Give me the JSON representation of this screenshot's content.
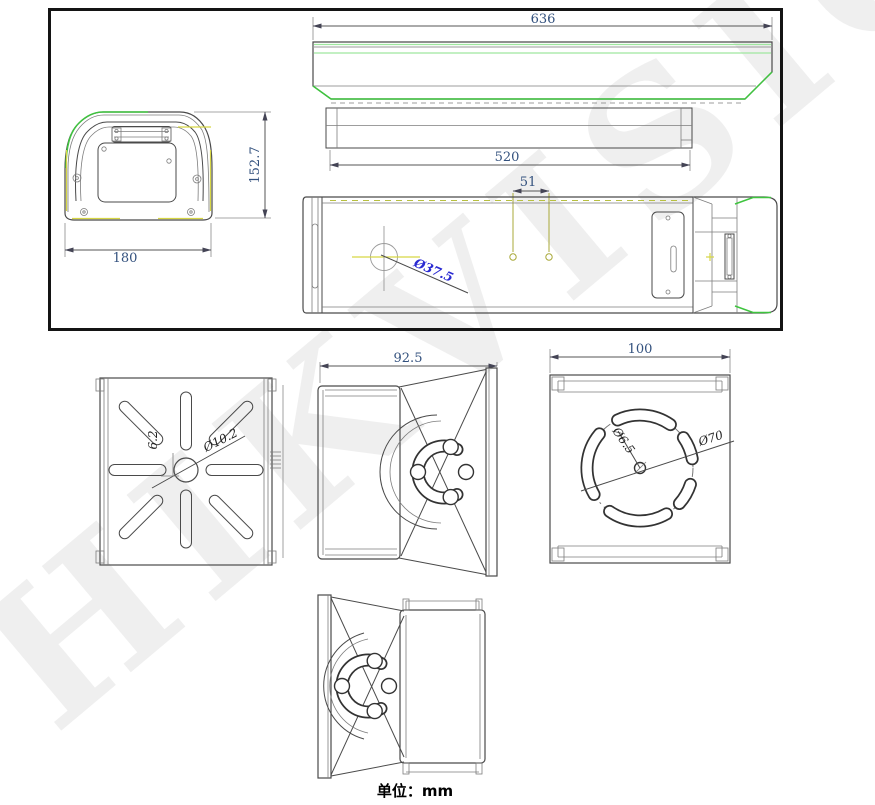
{
  "watermark": {
    "text": "HIKVISION"
  },
  "front_view": {
    "width_dim": "180",
    "height_dim": "152.7"
  },
  "top_view": {
    "overall_width_dim": "636",
    "body_width_dim": "520"
  },
  "bottom_view": {
    "hole_spacing_dim": "51",
    "hole_dia_label": "Ø37.5"
  },
  "plate_view": {
    "center_hole_label": "Ø10.2",
    "offset_dim": "6.2"
  },
  "side_view": {
    "depth_dim": "92.5"
  },
  "back_view": {
    "width_dim": "100",
    "center_hole_label": "Ø6.5",
    "slot_circle_label": "Ø70"
  },
  "footer": {
    "unit_label": "单位：mm"
  },
  "colors": {
    "accent_green": "#3ec43e",
    "accent_light_green": "#9fe89f",
    "accent_yellow": "#d6d645",
    "dim_text": "#33517e",
    "leader_blue": "#2a2ad2",
    "line": "#4a4a4a"
  }
}
